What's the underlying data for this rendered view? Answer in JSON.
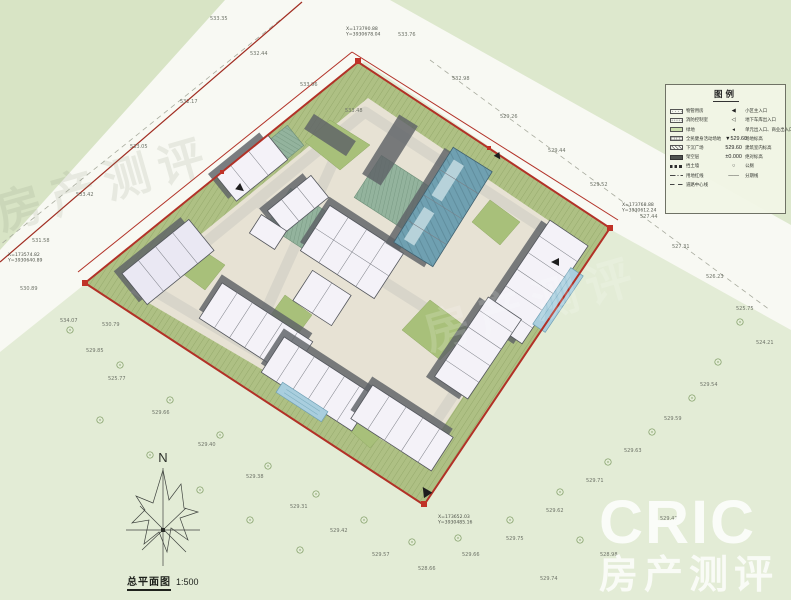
{
  "title_block": {
    "name": "总平面图",
    "scale": "1:500"
  },
  "north": {
    "label": "N"
  },
  "brand": {
    "logo": "CRIC",
    "sub": "房产测评"
  },
  "ghosts": [
    "房产测评",
    "房产测评"
  ],
  "legend": {
    "title": "图例",
    "left_items": [
      {
        "swatch": "dots",
        "label": "物管用房"
      },
      {
        "swatch": "dots2",
        "label": "消防控制室"
      },
      {
        "swatch": "green",
        "label": "绿地"
      },
      {
        "swatch": "grid",
        "label": "全民健身活动场地"
      },
      {
        "swatch": "diag",
        "label": "下沉广场"
      },
      {
        "swatch": "solid",
        "label": "架空层"
      },
      {
        "swatch": "dashes",
        "label": "挡土墙"
      },
      {
        "swatch": "dashdot",
        "label": "用地红线"
      },
      {
        "swatch": "dash2",
        "label": "道路中心线"
      }
    ],
    "right_items": [
      {
        "glyph": "◀",
        "label": "小区主入口"
      },
      {
        "glyph": "◁",
        "label": "地下车库出入口"
      },
      {
        "glyph": "◂",
        "label": "单元出入口、商业出入口"
      },
      {
        "glyph": "▼529.60",
        "label": "场地标高"
      },
      {
        "glyph": "529.60",
        "label": "建筑室内标高"
      },
      {
        "glyph": "±0.000",
        "label": "绝对标高"
      },
      {
        "glyph": "○",
        "label": "公厕"
      },
      {
        "glyph": "——",
        "label": "分期线"
      }
    ]
  },
  "boundary_coordinates": [
    {
      "x": 346,
      "y": 30,
      "lines": [
        "X=173790.88",
        "Y=3930678.04"
      ]
    },
    {
      "x": 622,
      "y": 206,
      "lines": [
        "X=173768.88",
        "Y=3930612.24"
      ]
    },
    {
      "x": 438,
      "y": 518,
      "lines": [
        "X=173652.03",
        "Y=3930485.16"
      ]
    },
    {
      "x": 8,
      "y": 256,
      "lines": [
        "X=173574.82",
        "Y=3930640.89"
      ]
    }
  ],
  "elevation_labels": [
    {
      "x": 250,
      "y": 55,
      "t": "532.44"
    },
    {
      "x": 210,
      "y": 20,
      "t": "533.35"
    },
    {
      "x": 180,
      "y": 103,
      "t": "532.17"
    },
    {
      "x": 130,
      "y": 148,
      "t": "533.05"
    },
    {
      "x": 76,
      "y": 196,
      "t": "533.42"
    },
    {
      "x": 32,
      "y": 242,
      "t": "531.58"
    },
    {
      "x": 300,
      "y": 86,
      "t": "533.96"
    },
    {
      "x": 345,
      "y": 112,
      "t": "533.48"
    },
    {
      "x": 398,
      "y": 36,
      "t": "533.76"
    },
    {
      "x": 452,
      "y": 80,
      "t": "532.98"
    },
    {
      "x": 500,
      "y": 118,
      "t": "529.26"
    },
    {
      "x": 548,
      "y": 152,
      "t": "529.44"
    },
    {
      "x": 590,
      "y": 186,
      "t": "529.52"
    },
    {
      "x": 640,
      "y": 218,
      "t": "527.44"
    },
    {
      "x": 672,
      "y": 248,
      "t": "527.31"
    },
    {
      "x": 706,
      "y": 278,
      "t": "526.23"
    },
    {
      "x": 736,
      "y": 310,
      "t": "525.75"
    },
    {
      "x": 756,
      "y": 344,
      "t": "524.21"
    },
    {
      "x": 700,
      "y": 386,
      "t": "529.54"
    },
    {
      "x": 664,
      "y": 420,
      "t": "529.59"
    },
    {
      "x": 624,
      "y": 452,
      "t": "529.63"
    },
    {
      "x": 586,
      "y": 482,
      "t": "529.71"
    },
    {
      "x": 546,
      "y": 512,
      "t": "529.62"
    },
    {
      "x": 506,
      "y": 540,
      "t": "529.75"
    },
    {
      "x": 462,
      "y": 556,
      "t": "529.66"
    },
    {
      "x": 418,
      "y": 570,
      "t": "528.66"
    },
    {
      "x": 372,
      "y": 556,
      "t": "529.57"
    },
    {
      "x": 330,
      "y": 532,
      "t": "529.42"
    },
    {
      "x": 290,
      "y": 508,
      "t": "529.31"
    },
    {
      "x": 246,
      "y": 478,
      "t": "529.38"
    },
    {
      "x": 198,
      "y": 446,
      "t": "529.40"
    },
    {
      "x": 152,
      "y": 414,
      "t": "529.66"
    },
    {
      "x": 108,
      "y": 380,
      "t": "525.77"
    },
    {
      "x": 86,
      "y": 352,
      "t": "529.85"
    },
    {
      "x": 60,
      "y": 322,
      "t": "534.07"
    },
    {
      "x": 102,
      "y": 326,
      "t": "530.79"
    },
    {
      "x": 20,
      "y": 290,
      "t": "530.89"
    },
    {
      "x": 540,
      "y": 580,
      "t": "529.74"
    },
    {
      "x": 600,
      "y": 556,
      "t": "528.98"
    },
    {
      "x": 660,
      "y": 520,
      "t": "529.47"
    }
  ],
  "trees": [
    [
      70,
      330
    ],
    [
      120,
      365
    ],
    [
      170,
      400
    ],
    [
      220,
      435
    ],
    [
      268,
      466
    ],
    [
      316,
      494
    ],
    [
      364,
      520
    ],
    [
      412,
      542
    ],
    [
      458,
      538
    ],
    [
      300,
      550
    ],
    [
      250,
      520
    ],
    [
      200,
      490
    ],
    [
      150,
      455
    ],
    [
      100,
      420
    ],
    [
      510,
      520
    ],
    [
      560,
      492
    ],
    [
      608,
      462
    ],
    [
      652,
      432
    ],
    [
      692,
      398
    ],
    [
      718,
      362
    ],
    [
      740,
      322
    ],
    [
      580,
      540
    ]
  ],
  "colors": {
    "base_green": "#e3ecd6",
    "topleft_green": "#d8e4c5",
    "topright_green": "#dde8cd",
    "road_white": "#f8f9f3",
    "site_paving": "#e7e2d4",
    "olive": "#aec084",
    "olive_line": "#7e9455",
    "lawn": "#a8c07a",
    "building_white": "#f4f2f8",
    "building_outline": "#53565c",
    "shadow": "#5e6267",
    "teal_building": "#6fa0b1",
    "canopy": "#93b39d",
    "pool": "#a9cede",
    "inner_road": "#d8d5ca",
    "red": "#b23127",
    "label_grey": "#6e7368",
    "tree_green": "#7d9b62"
  }
}
